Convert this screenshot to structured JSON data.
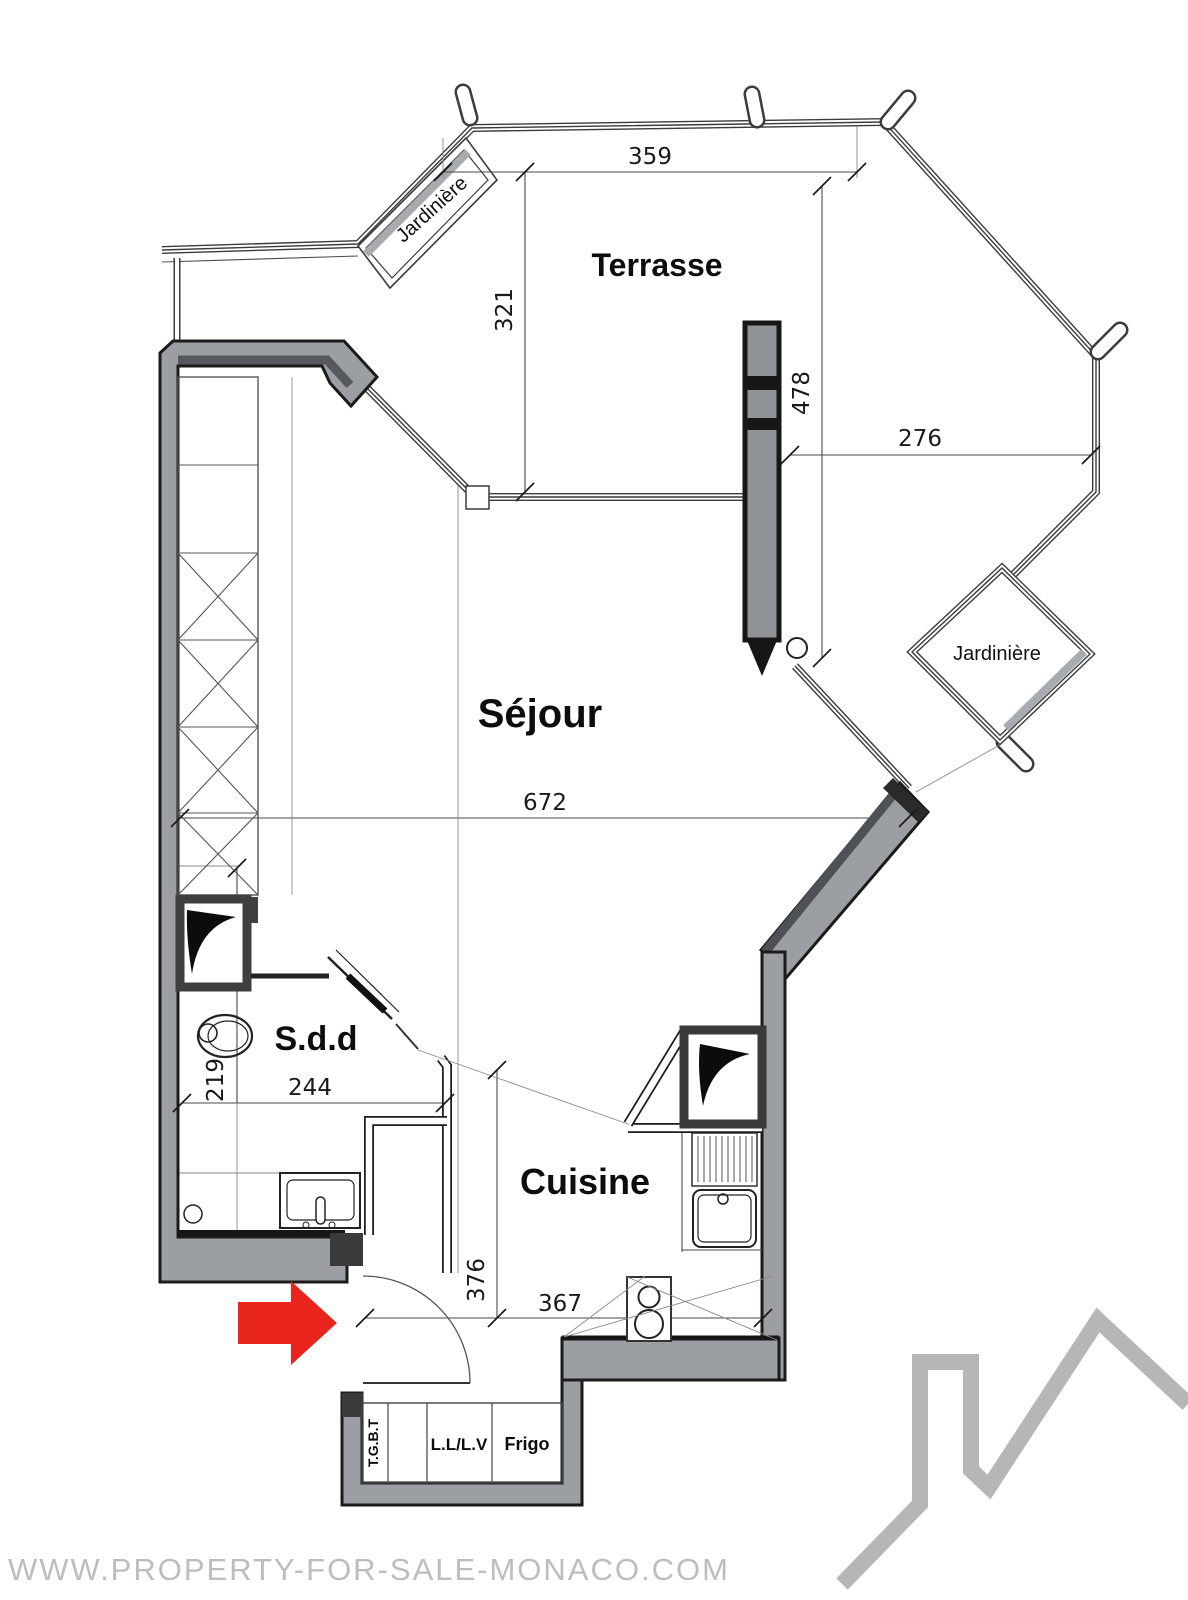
{
  "rooms": {
    "terrasse": "Terrasse",
    "sejour": "Séjour",
    "sdd": "S.d.d",
    "cuisine": "Cuisine"
  },
  "features": {
    "jardiniere_left": "Jardinière",
    "jardiniere_right": "Jardinière",
    "tgbt": "T.G.B.T",
    "washer_dishwasher": "L.L/L.V",
    "fridge": "Frigo"
  },
  "dimensions_cm": {
    "terrasse_width": "359",
    "terrasse_depth": "321",
    "terrasse_east_depth": "478",
    "terrasse_east_width": "276",
    "sejour_width": "672",
    "sdd_depth": "219",
    "sdd_width": "244",
    "cuisine_depth": "376",
    "entry_width": "367"
  },
  "watermark": "WWW.PROPERTY-FOR-SALE-MONACO.COM",
  "colors": {
    "wall_gray": "#9b9ea3",
    "line_dark": "#1b1b1b",
    "entry_arrow_red": "#e9241c",
    "logo_gray": "#b6b6b6",
    "watermark_gray": "#bdbdbd"
  }
}
